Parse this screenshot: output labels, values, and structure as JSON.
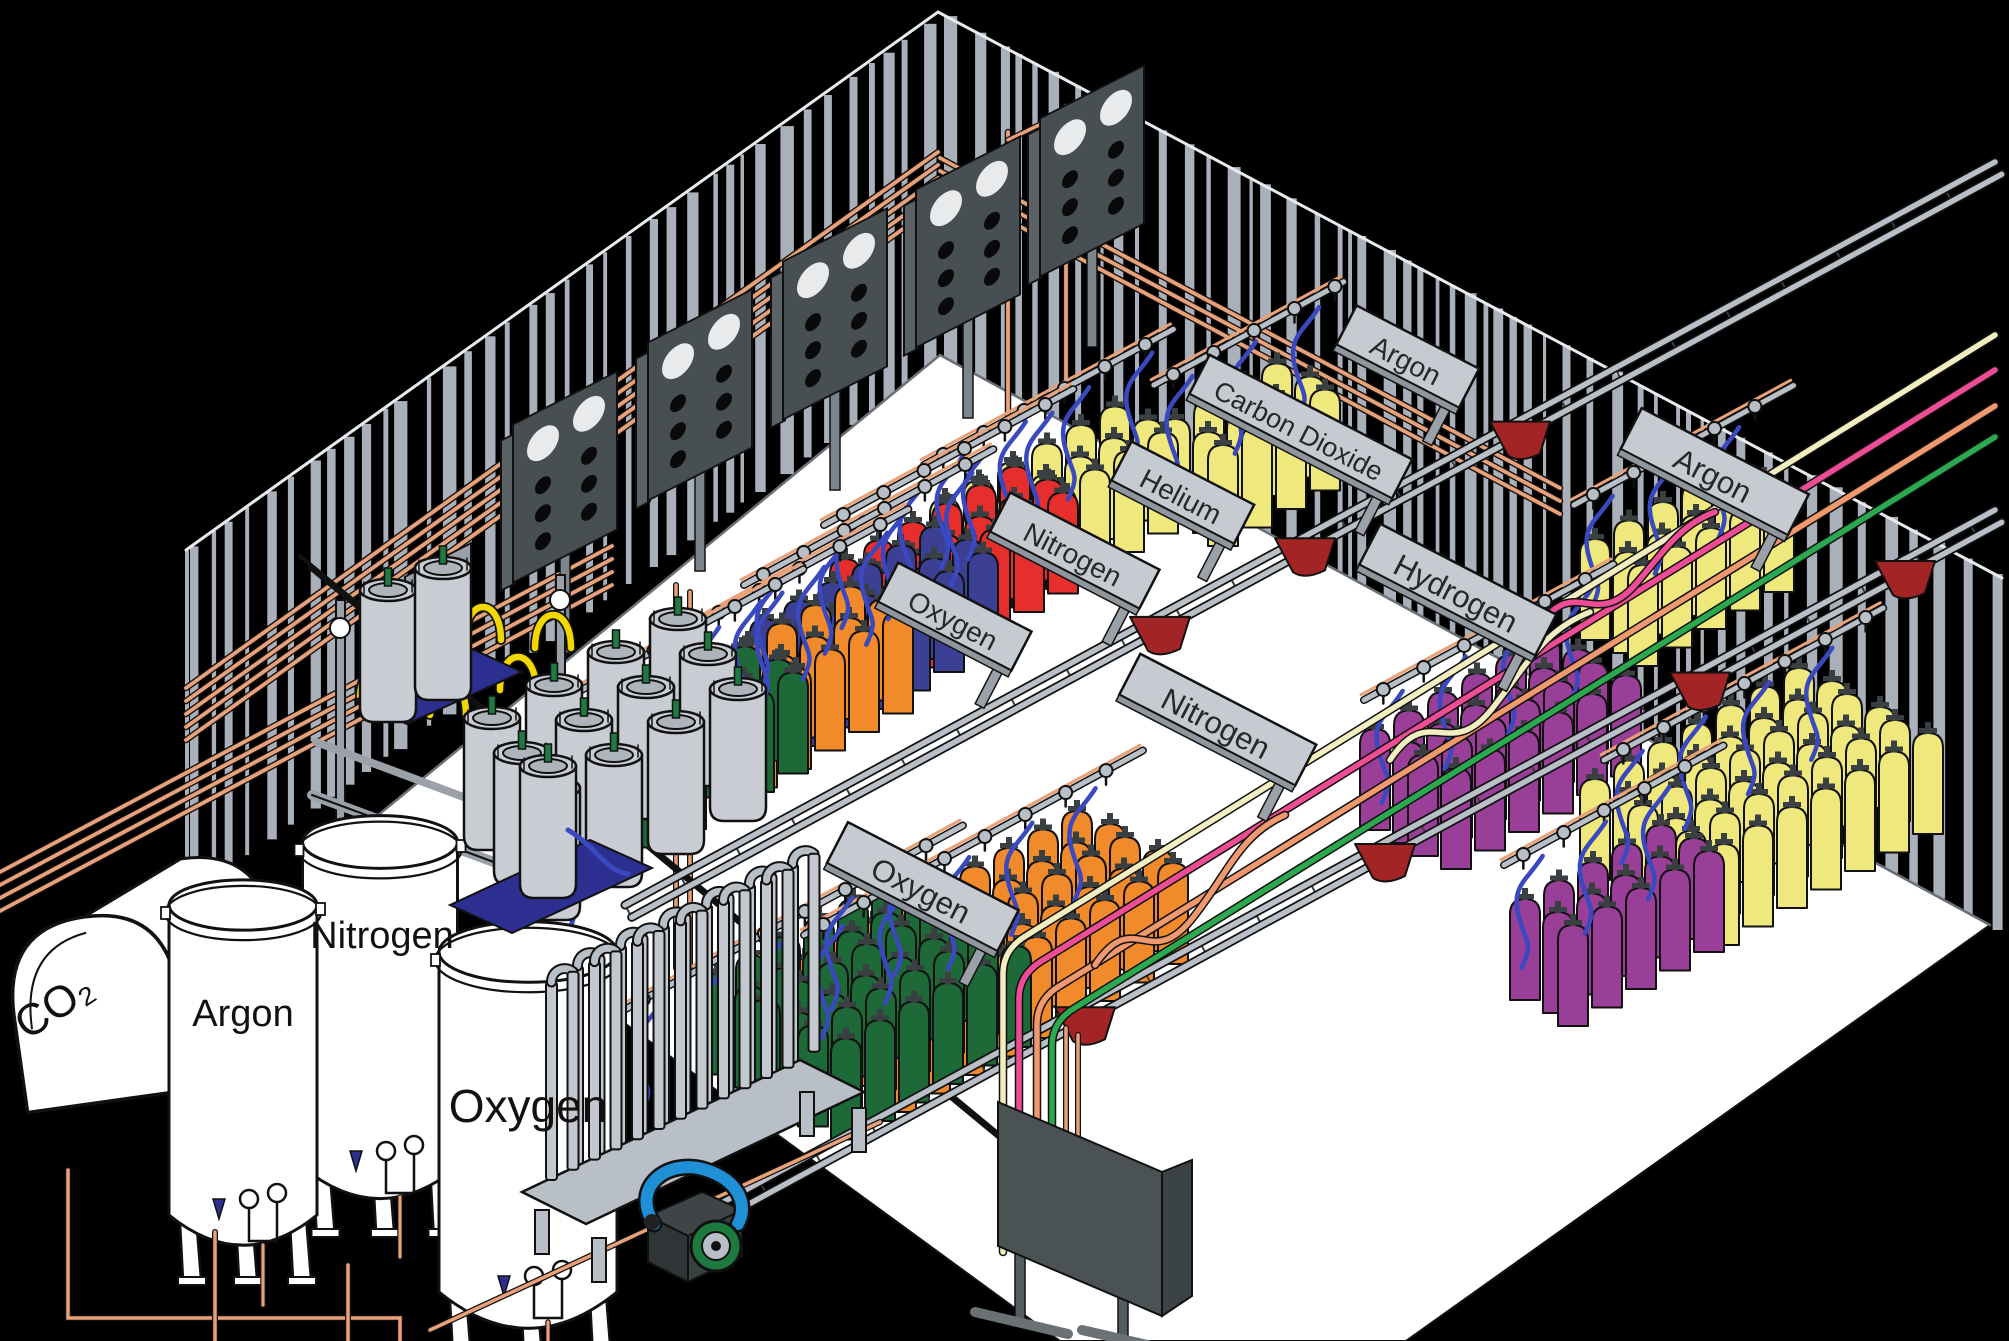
{
  "scene": {
    "title": "Industrial gas cylinder filling plant (isometric cutaway)",
    "colors": {
      "background": "#000000",
      "floor": "#ffffff",
      "wall_stripe": "#a9b0ba",
      "wall_edge": "#e8ebee",
      "copper_pipe": "#e8a178",
      "black_pipe": "#111111",
      "rail_gray": "#b9bfc7",
      "cart_red": "#a32424",
      "hose_blue": "#3a49c0",
      "pigtail_yellow": "#f2d800",
      "banner_face": "#c6cbd2",
      "banner_text": "#26282b",
      "manifold_board": "#474f52",
      "dewar_body": "#c9cdd3",
      "dewar_valve_green": "#1e7a40",
      "pallet_blue": "#2c2f8f",
      "tank_white": "#ffffff",
      "pump_green": "#1d7a3e",
      "pump_hose_blue": "#1f8fd6",
      "panel_dark": "#4a5254",
      "line_cream": "#f2eec0",
      "line_pink": "#ee4d96",
      "line_salmon": "#f0996e",
      "line_green": "#2ba94f"
    },
    "bulk_storage": {
      "co2_tank_label": "CO₂",
      "argon_tank_label": "Argon",
      "nitrogen_tank_label": "Nitrogen",
      "oxygen_tank_label": "Oxygen"
    },
    "fill_stations": [
      {
        "id": "oxygen-back",
        "label": "Oxygen",
        "cylinder_color": "#1d6a38"
      },
      {
        "id": "nitrogen-back",
        "label": "Nitrogen",
        "cylinder_color": "#3c4094"
      },
      {
        "id": "helium",
        "label": "Helium",
        "cylinder_color": "#e62e2d"
      },
      {
        "id": "carbon-dioxide",
        "label": "Carbon Dioxide",
        "cylinder_color": "#efe87c"
      },
      {
        "id": "argon-back",
        "label": "Argon",
        "cylinder_color": "#efe87c"
      },
      {
        "id": "argon-right",
        "label": "Argon",
        "cylinder_color": "#efe87c"
      },
      {
        "id": "hydrogen",
        "label": "Hydrogen",
        "cylinder_color": "#9a3f98"
      },
      {
        "id": "nitrogen-center",
        "label": "Nitrogen",
        "cylinder_color": "#f18a2b"
      },
      {
        "id": "oxygen-front",
        "label": "Oxygen",
        "cylinder_color": "#1d6a38"
      }
    ]
  }
}
